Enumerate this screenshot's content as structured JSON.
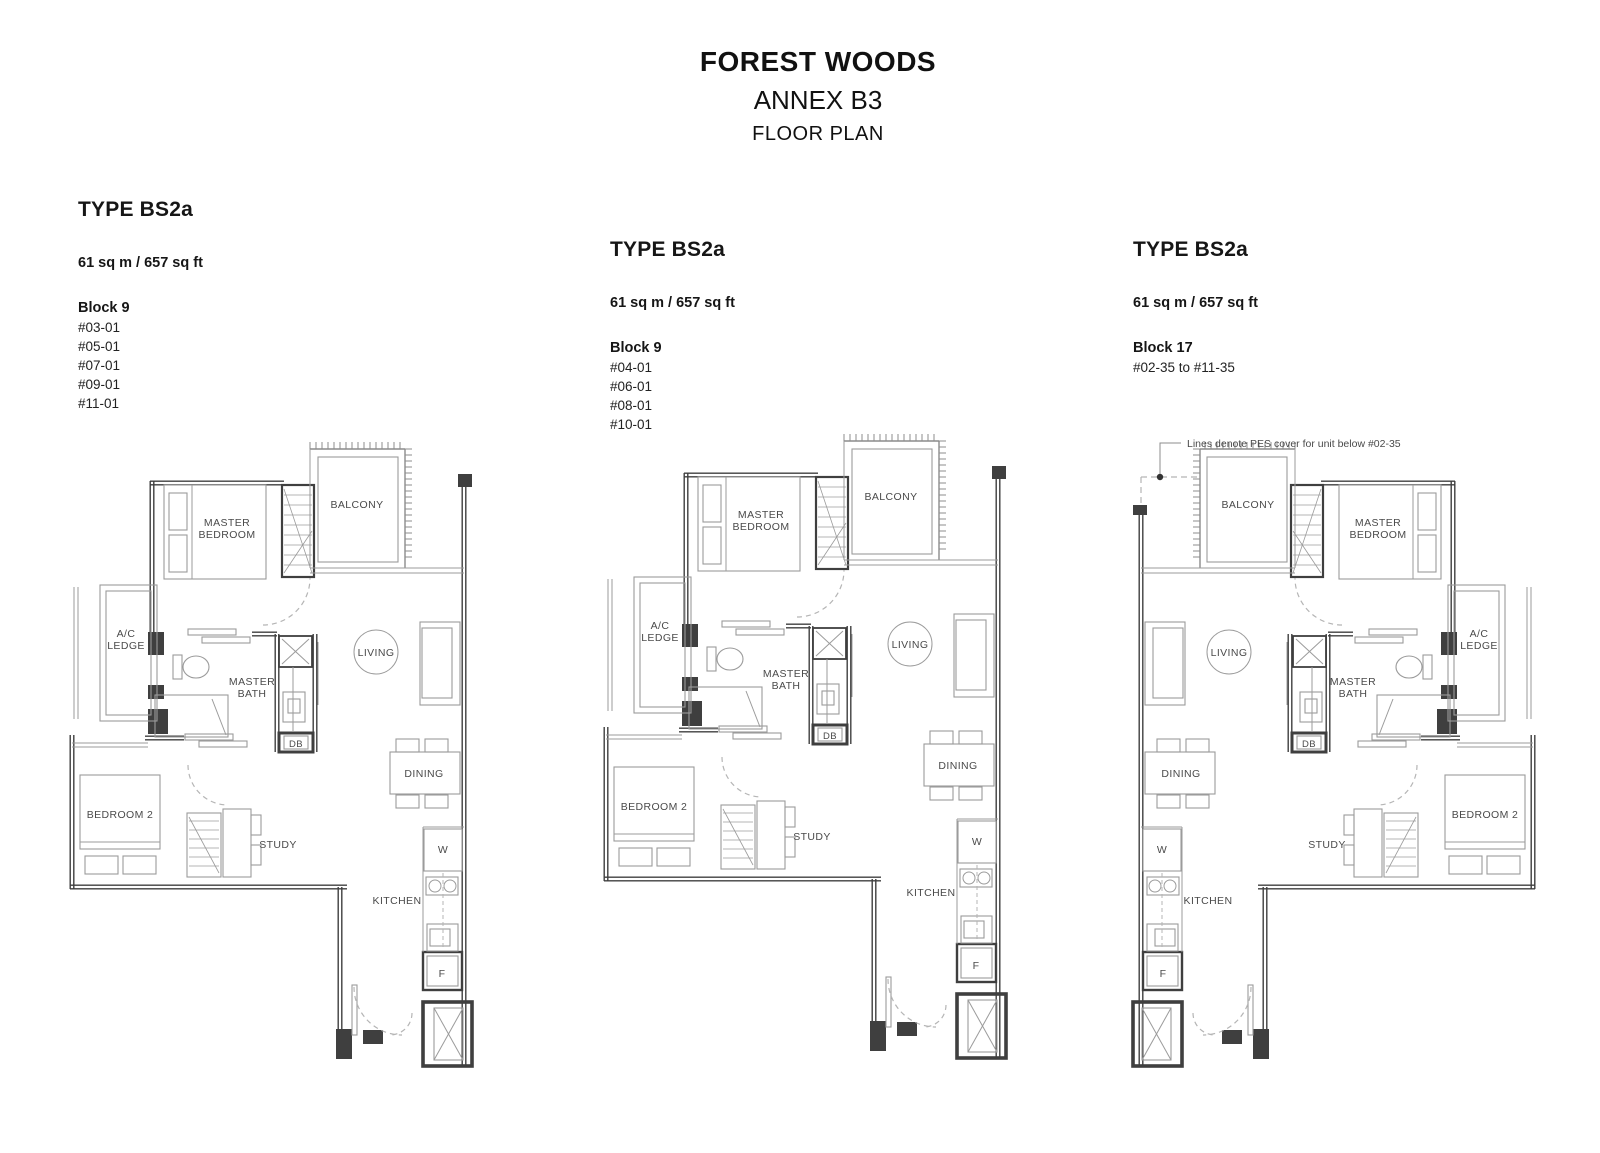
{
  "header": {
    "project": "FOREST WOODS",
    "annex": "ANNEX B3",
    "subtitle": "FLOOR PLAN"
  },
  "units": [
    {
      "type": "TYPE BS2a",
      "area": "61 sq m / 657 sq ft",
      "block": "Block 9",
      "stacks": [
        "#03-01",
        "#05-01",
        "#07-01",
        "#09-01",
        "#11-01"
      ]
    },
    {
      "type": "TYPE BS2a",
      "area": "61 sq m / 657 sq ft",
      "block": "Block 9",
      "stacks": [
        "#04-01",
        "#06-01",
        "#08-01",
        "#10-01"
      ]
    },
    {
      "type": "TYPE BS2a",
      "area": "61 sq m / 657 sq ft",
      "block": "Block 17",
      "stacks": [
        "#02-35 to #11-35"
      ]
    }
  ],
  "plan_labels": {
    "balcony": "BALCONY",
    "master_bedroom": [
      "MASTER",
      "BEDROOM"
    ],
    "ac_ledge": [
      "A/C",
      "LEDGE"
    ],
    "master_bath": [
      "MASTER",
      "BATH"
    ],
    "living": "LIVING",
    "dining": "DINING",
    "bedroom2": "BEDROOM 2",
    "study": "STUDY",
    "kitchen": "KITCHEN",
    "washer": "W",
    "fridge": "F",
    "db": "DB"
  },
  "annotation": {
    "pes_note": "Lines denote PES cover for unit below #02-35"
  },
  "colors": {
    "wall": "#3f3f3f",
    "thin": "#9b9b9b",
    "fixture": "#8c8c8c",
    "label": "#4a4a4a",
    "dashed": "#b5b5b5"
  }
}
